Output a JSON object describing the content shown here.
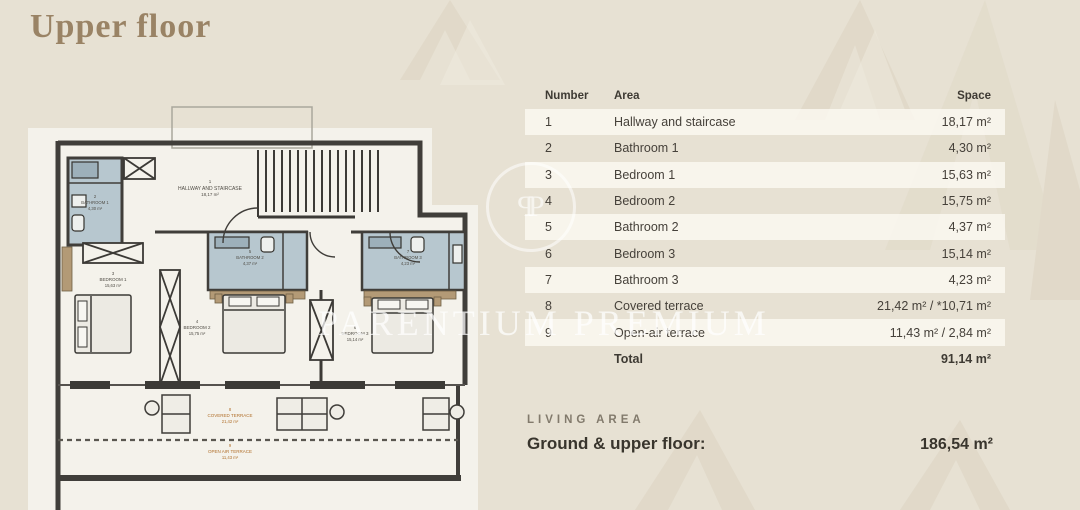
{
  "page": {
    "title": "Upper floor"
  },
  "watermark": {
    "brand_text": "PARENTIUM PREMIUM",
    "monogram_letter": "P"
  },
  "table": {
    "headers": {
      "number": "Number",
      "area": "Area",
      "space": "Space"
    },
    "rows": [
      {
        "number": "1",
        "area": "Hallway and staircase",
        "space": "18,17 m²"
      },
      {
        "number": "2",
        "area": "Bathroom 1",
        "space": "4,30 m²"
      },
      {
        "number": "3",
        "area": "Bedroom 1",
        "space": "15,63 m²"
      },
      {
        "number": "4",
        "area": "Bedroom 2",
        "space": "15,75 m²"
      },
      {
        "number": "5",
        "area": "Bathroom 2",
        "space": "4,37 m²"
      },
      {
        "number": "6",
        "area": "Bedroom 3",
        "space": "15,14 m²"
      },
      {
        "number": "7",
        "area": "Bathroom 3",
        "space": "4,23 m²"
      },
      {
        "number": "8",
        "area": "Covered terrace",
        "space": "21,42 m² / *10,71 m²"
      },
      {
        "number": "9",
        "area": "Open-air terrace",
        "space": "11,43 m² / 2,84 m²"
      }
    ],
    "total": {
      "label": "Total",
      "space": "91,14 m²"
    }
  },
  "living_area": {
    "section_label": "LIVING AREA",
    "row_label": "Ground & upper floor:",
    "value": "186,54 m²"
  },
  "floor_plan": {
    "labels": {
      "hallway": {
        "no": "1",
        "name": "HALLWAY AND STAIRCASE",
        "size": "18,17 m²"
      },
      "bathroom1": {
        "no": "2",
        "name": "BATHROOM 1",
        "size": "4,30 m²"
      },
      "bedroom1": {
        "no": "3",
        "name": "BEDROOM 1",
        "size": "15,63 m²"
      },
      "bedroom2": {
        "no": "4",
        "name": "BEDROOM 2",
        "size": "15,75 m²"
      },
      "bathroom2": {
        "no": "5",
        "name": "BATHROOM 2",
        "size": "4,37 m²"
      },
      "bedroom3": {
        "no": "6",
        "name": "BEDROOM 3",
        "size": "15,14 m²"
      },
      "bathroom3": {
        "no": "7",
        "name": "BATHROOM 3",
        "size": "4,23 m²"
      },
      "covered_terrace": {
        "no": "8",
        "name": "COVERED TERRACE",
        "size": "21,42 m²"
      },
      "open_terrace": {
        "no": "9",
        "name": "OPEN AIR TERRACE",
        "size": "11,43 m²"
      }
    }
  },
  "colors": {
    "background": "#e7e1d3",
    "plan_canvas": "#f4f2eb",
    "wall": "#403e3a",
    "bathroom_fill": "#b7c7cf",
    "wardrobe_tan": "#b39a76",
    "terrace_label": "#b06f2a",
    "title": "#9a8365",
    "table_text": "#46413a"
  }
}
